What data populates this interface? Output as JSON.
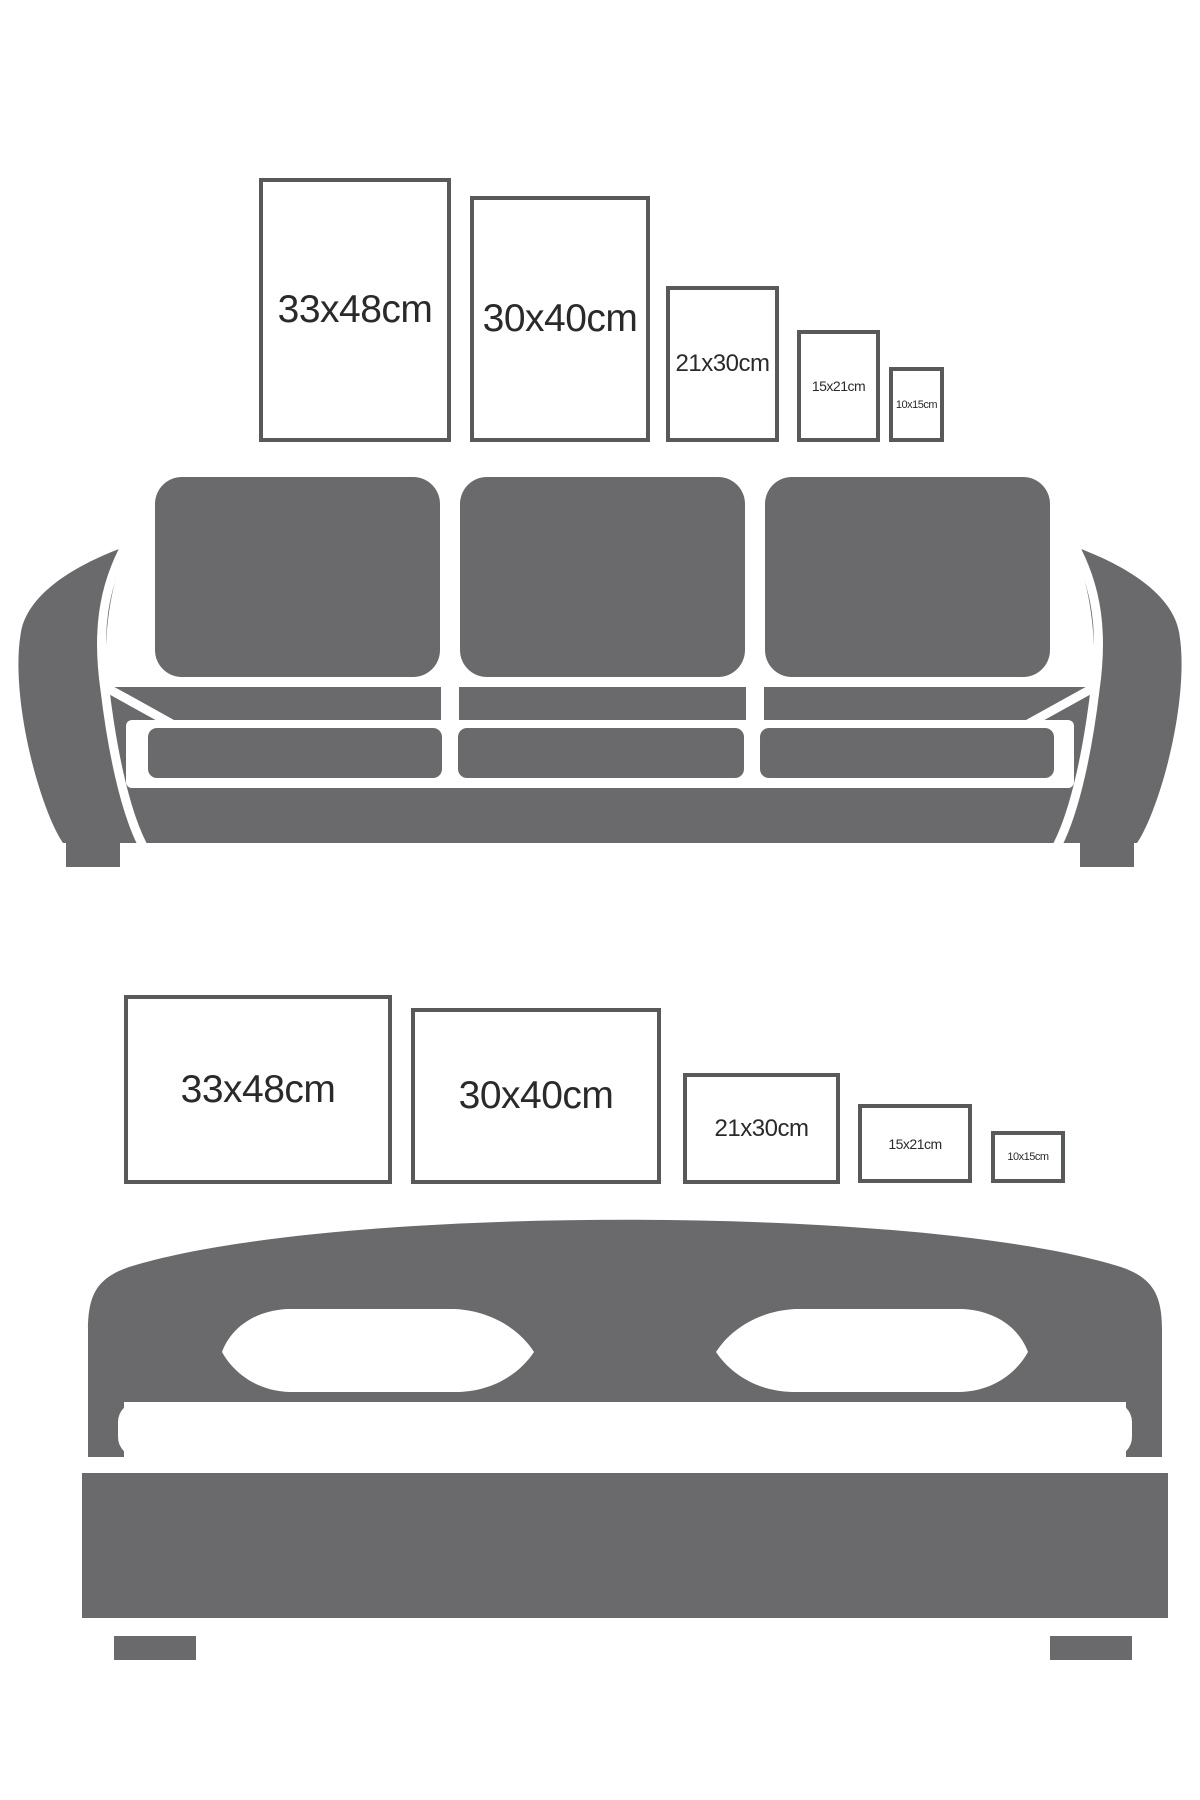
{
  "colors": {
    "background": "#ffffff",
    "furniture_gray": "#6a6a6c",
    "frame_border": "#58595b",
    "label_text": "#2a2a2a",
    "cutout_white": "#ffffff"
  },
  "top_section": {
    "icon": "sofa-icon",
    "frames": [
      {
        "label": "33x48cm",
        "orientation": "portrait"
      },
      {
        "label": "30x40cm",
        "orientation": "portrait"
      },
      {
        "label": "21x30cm",
        "orientation": "portrait"
      },
      {
        "label": "15x21cm",
        "orientation": "portrait"
      },
      {
        "label": "10x15cm",
        "orientation": "portrait"
      }
    ]
  },
  "bottom_section": {
    "icon": "bed-icon",
    "frames": [
      {
        "label": "33x48cm",
        "orientation": "landscape"
      },
      {
        "label": "30x40cm",
        "orientation": "landscape"
      },
      {
        "label": "21x30cm",
        "orientation": "landscape"
      },
      {
        "label": "15x21cm",
        "orientation": "landscape"
      },
      {
        "label": "10x15cm",
        "orientation": "landscape"
      }
    ]
  }
}
